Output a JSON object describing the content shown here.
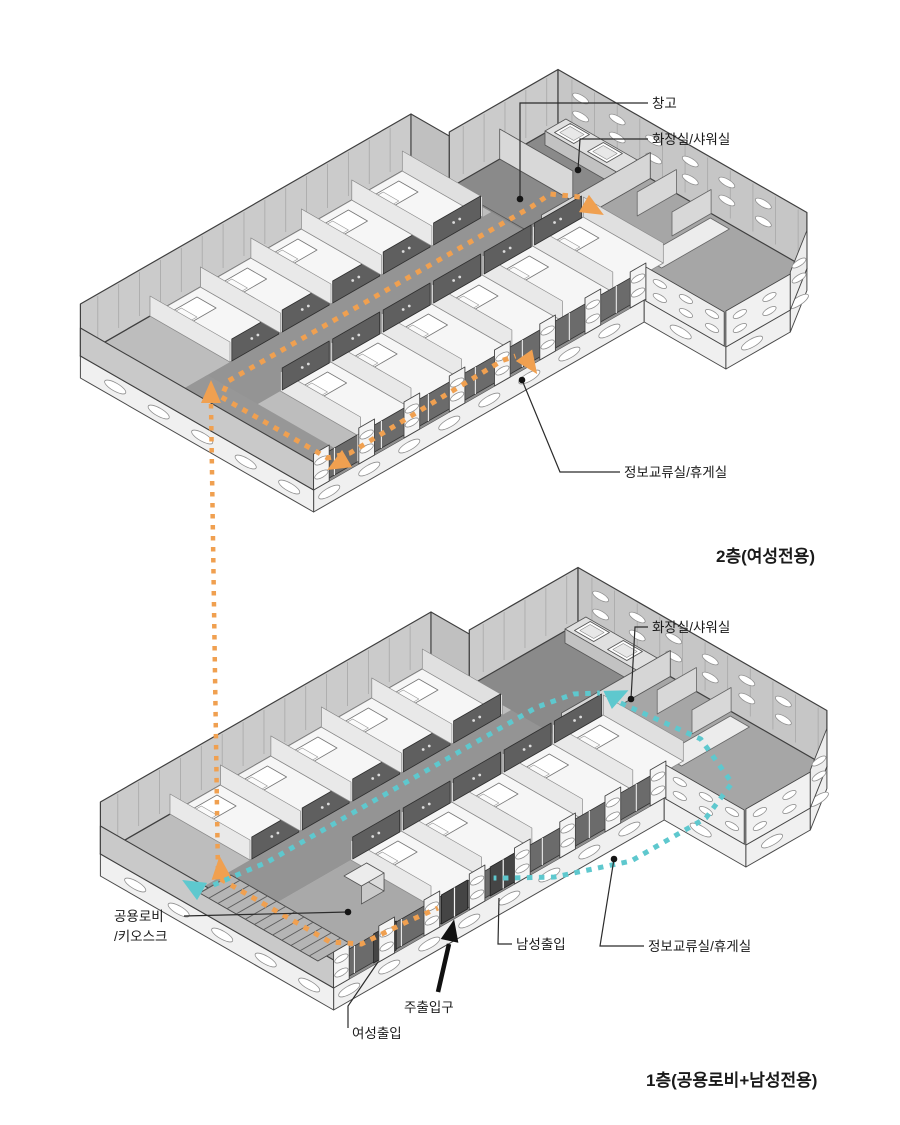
{
  "floor2": {
    "title": "2층(여성전용)",
    "callouts": {
      "storage": "창고",
      "toilet": "화장실/샤워실",
      "lounge": "정보교류실/휴게실"
    }
  },
  "floor1": {
    "title": "1층(공용로비+남성전용)",
    "callouts": {
      "toilet": "화장실/샤워실",
      "lobby_line1": "공용로비",
      "lobby_line2": "/키오스크",
      "lounge": "정보교류실/휴게실",
      "men_entrance": "남성출입",
      "main_entrance": "주출입구",
      "women_entrance": "여성출입"
    }
  },
  "routes": {
    "women_route_color": "#F0A050",
    "men_route_color": "#5EC8CE"
  },
  "palette": {
    "background": "#ffffff",
    "leader_line": "#2b2b2b",
    "black_arrow": "#111111",
    "wall_light": "#cbcbcb",
    "door_wall_dark": "#5f5f5f",
    "corridor_floor": "#949494",
    "room_floor": "#f6f6f6"
  }
}
